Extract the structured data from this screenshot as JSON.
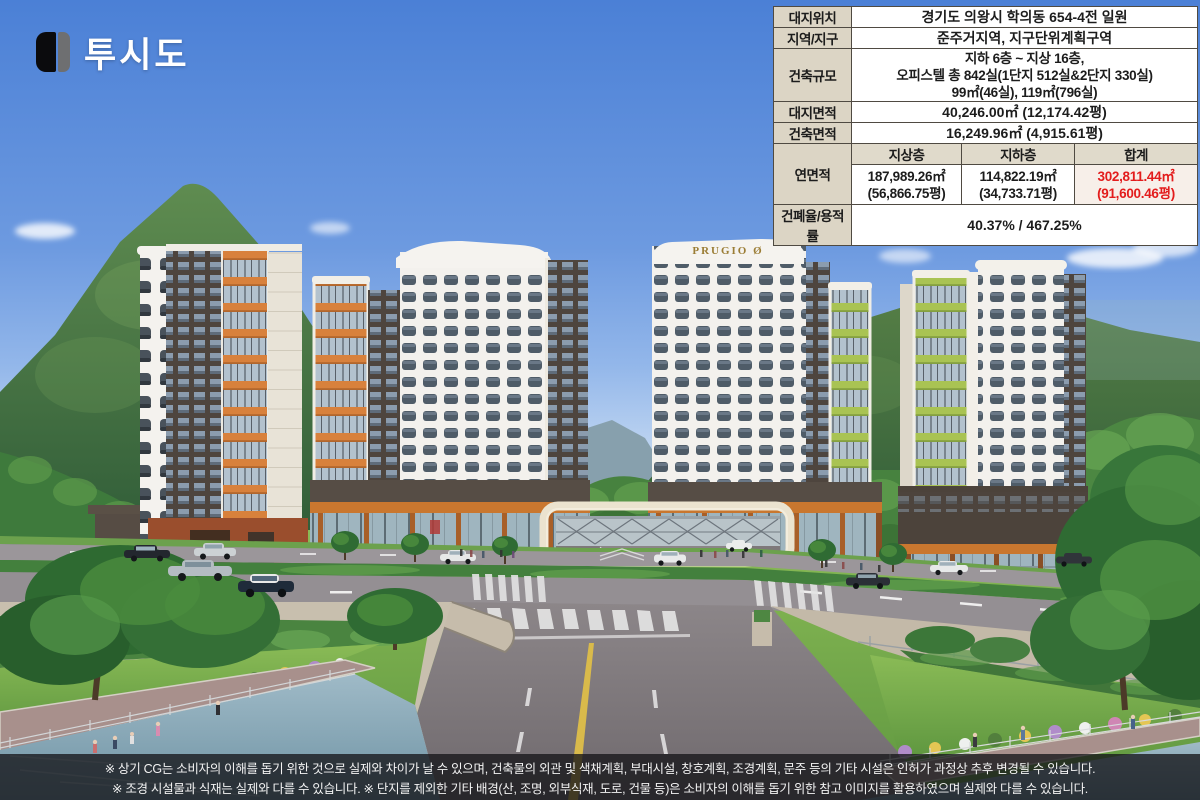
{
  "header": {
    "title": "투시도"
  },
  "icons": {
    "logo_mark": "double-bar-icon"
  },
  "scene": {
    "prugio_sign": "PRUGIO Ø"
  },
  "info_table": {
    "site_location": {
      "label": "대지위치",
      "value": "경기도 의왕시 학의동 654-4전 일원"
    },
    "zoning": {
      "label": "지역/지구",
      "value": "준주거지역, 지구단위계획구역"
    },
    "scale": {
      "label": "건축규모",
      "line1": "지하 6층 ~ 지상 16층,",
      "line2": "오피스텔 총 842실(1단지 512실&2단지 330실)",
      "line3": "99㎡(46실), 119㎡(796실)"
    },
    "site_area": {
      "label": "대지면적",
      "value": "40,246.00㎡ (12,174.42평)"
    },
    "building_area": {
      "label": "건축면적",
      "value": "16,249.96㎡ (4,915.61평)"
    },
    "floor_area": {
      "label": "연면적",
      "headers": {
        "above": "지상층",
        "below": "지하층",
        "total": "합계"
      },
      "above": {
        "area": "187,989.26㎡",
        "pyeong": "(56,866.75평)"
      },
      "below": {
        "area": "114,822.19㎡",
        "pyeong": "(34,733.71평)"
      },
      "total": {
        "area": "302,811.44㎡",
        "pyeong": "(91,600.46평)"
      }
    },
    "ratio": {
      "label": "건폐율/용적률",
      "value": "40.37% / 467.25%"
    }
  },
  "disclaimer": {
    "line1": "※ 상기 CG는 소비자의 이해를 돕기 위한 것으로 실제와 차이가 날 수 있으며, 건축물의 외관 및 색채계획, 부대시설, 창호계획, 조경계획, 문주 등의 기타 시설은 인허가 과정상 추후 변경될 수 있습니다.",
    "line2": "※ 조경 시설물과 식재는 실제와 다를 수 있습니다. ※ 단지를 제외한 기타 배경(산, 조명, 외부식재, 도로, 건물 등)은 소비자의 이해를 돕기 위한 참고 이미지를 활용하였으며 실제와 다를 수 있습니다."
  },
  "colors": {
    "sky_blue": "#4b80d6",
    "accent_orange": "#d8813c",
    "accent_lime": "#a9c353",
    "brand_gold": "#9b7d35",
    "table_label_bg": "#dcd5c5",
    "highlight_red": "#e31c1c"
  }
}
